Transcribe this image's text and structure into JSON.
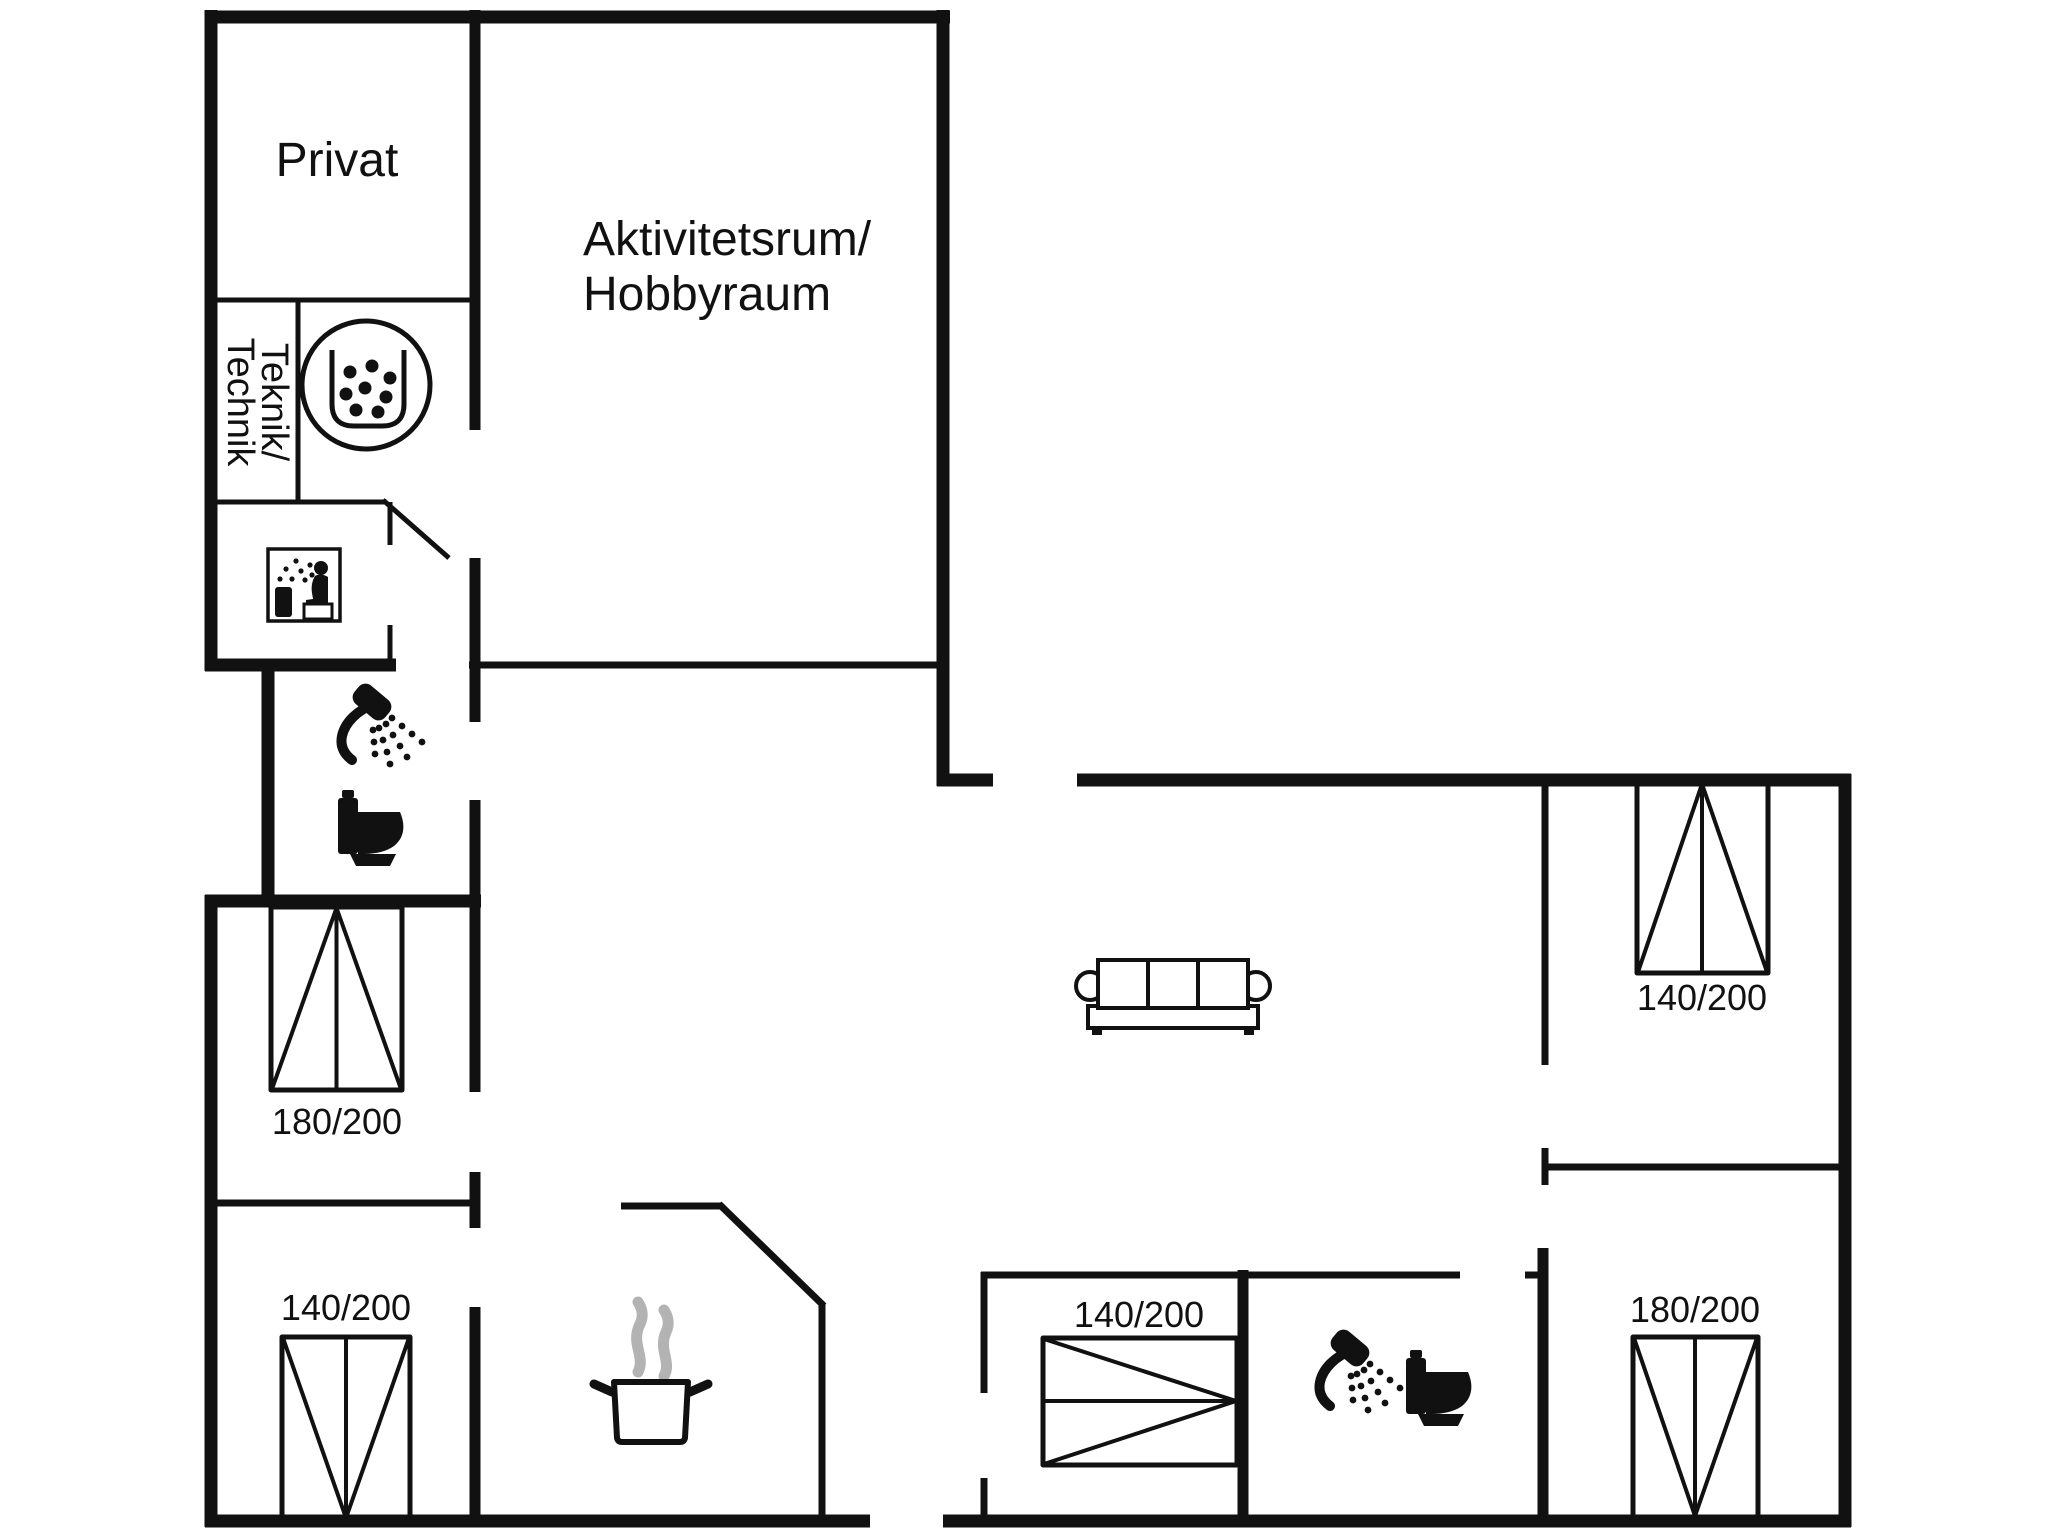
{
  "colors": {
    "background": "#ffffff",
    "ink": "#111111",
    "steam": "#b3b3b3"
  },
  "rooms": {
    "privat": {
      "label": "Privat"
    },
    "activity_room": {
      "line1": "Aktivitetsrum/",
      "line2": "Hobbyraum"
    },
    "technical_room": {
      "line1": "Teknik/",
      "line2": "Technik"
    }
  },
  "beds": {
    "left_upper": {
      "size": "180/200"
    },
    "left_lower": {
      "size": "140/200"
    },
    "right_upper": {
      "size": "140/200"
    },
    "right_lower": {
      "size": "180/200"
    },
    "center_lower": {
      "size": "140/200"
    }
  },
  "icons": {
    "shower": "shower-icon",
    "toilet": "toilet-icon",
    "sauna": "sauna-icon",
    "whirlpool": "whirlpool-icon",
    "cooking_pot": "cooking-pot-icon",
    "steam": "steam-icon",
    "sofa": "sofa-icon",
    "bed": "bed-symbol"
  }
}
